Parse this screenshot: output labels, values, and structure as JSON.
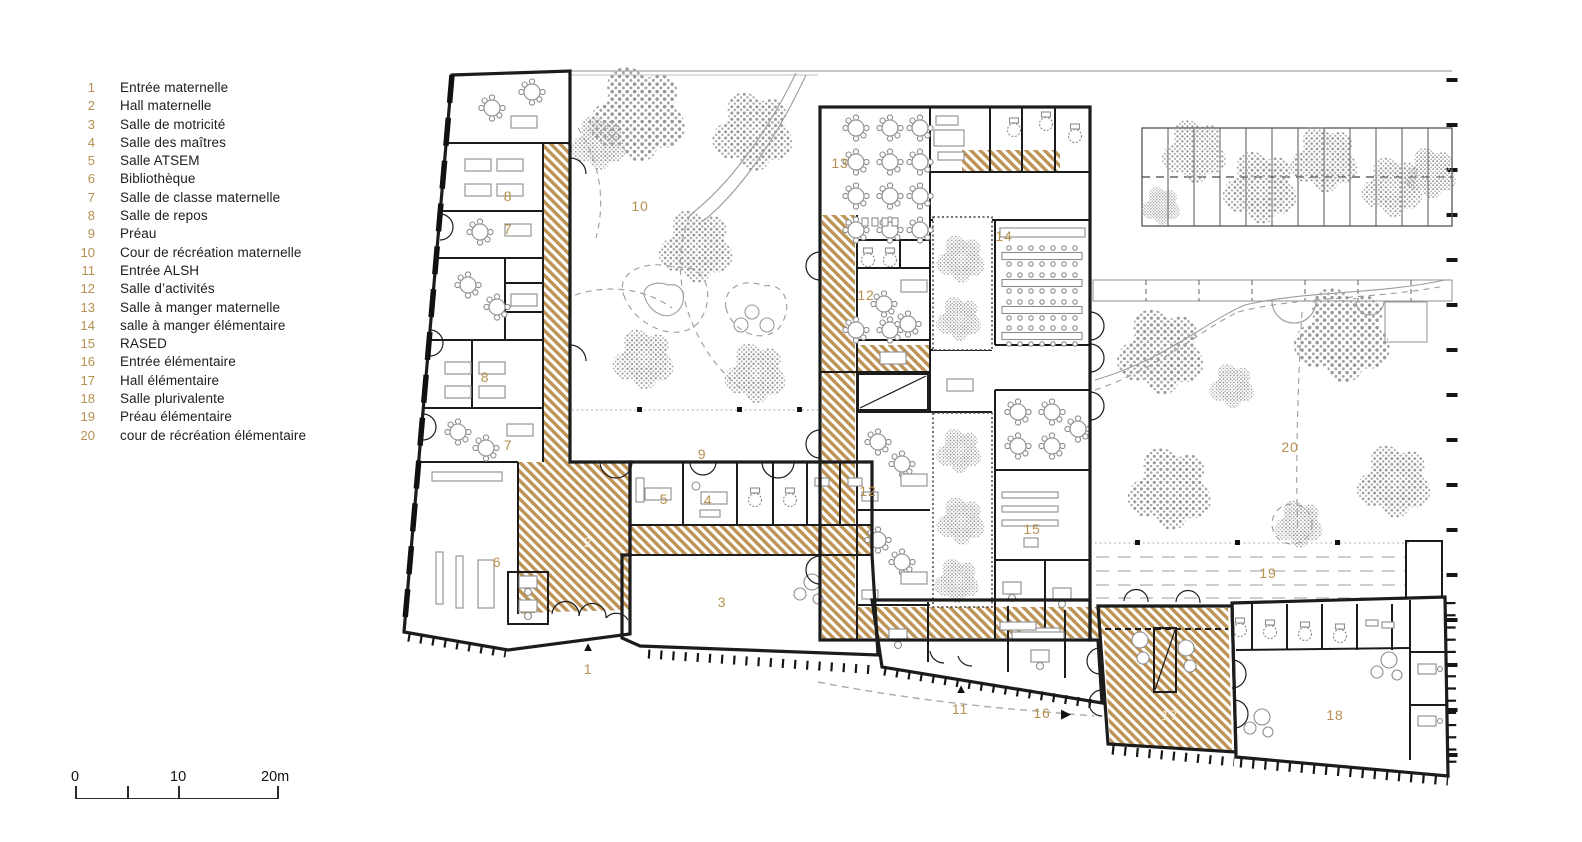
{
  "legend": {
    "items": [
      {
        "num": "1",
        "label": "Entrée maternelle"
      },
      {
        "num": "2",
        "label": "Hall maternelle"
      },
      {
        "num": "3",
        "label": "Salle de motricité"
      },
      {
        "num": "4",
        "label": "Salle des maîtres"
      },
      {
        "num": "5",
        "label": "Salle ATSEM"
      },
      {
        "num": "6",
        "label": "Bibliothèque"
      },
      {
        "num": "7",
        "label": "Salle de classe maternelle"
      },
      {
        "num": "8",
        "label": "Salle de repos"
      },
      {
        "num": "9",
        "label": "Préau"
      },
      {
        "num": "10",
        "label": "Cour de récréation maternelle"
      },
      {
        "num": "11",
        "label": "Entrée ALSH"
      },
      {
        "num": "12",
        "label": "Salle d’activités"
      },
      {
        "num": "13",
        "label": "Salle à manger maternelle"
      },
      {
        "num": "14",
        "label": "salle à manger élémentaire"
      },
      {
        "num": "15",
        "label": "RASED"
      },
      {
        "num": "16",
        "label": "Entrée élémentaire"
      },
      {
        "num": "17",
        "label": "Hall élémentaire"
      },
      {
        "num": "18",
        "label": "Salle plurivalente"
      },
      {
        "num": "19",
        "label": "Préau élémentaire"
      },
      {
        "num": "20",
        "label": "cour de récréation élémentaire"
      }
    ]
  },
  "scale": {
    "ticks": [
      "0",
      "10",
      "20m"
    ]
  },
  "plan": {
    "labels": [
      {
        "num": "8"
      },
      {
        "num": "7"
      },
      {
        "num": "10"
      },
      {
        "num": "13"
      },
      {
        "num": "14"
      },
      {
        "num": "12"
      },
      {
        "num": "8"
      },
      {
        "num": "7"
      },
      {
        "num": "9"
      },
      {
        "num": "12"
      },
      {
        "num": "5"
      },
      {
        "num": "4"
      },
      {
        "num": "15"
      },
      {
        "num": "2"
      },
      {
        "num": "6"
      },
      {
        "num": "3"
      },
      {
        "num": "20"
      },
      {
        "num": "19"
      },
      {
        "num": "1"
      },
      {
        "num": "11"
      },
      {
        "num": "16"
      },
      {
        "num": "17"
      },
      {
        "num": "18"
      }
    ],
    "markers": [
      {
        "name": "entrance-maternelle-marker",
        "glyph": "▲"
      },
      {
        "name": "entrance-alsh-marker",
        "glyph": "▲"
      },
      {
        "name": "entrance-elementaire-marker",
        "glyph": "▶"
      }
    ],
    "colors": {
      "accent_gold": "#b6904f",
      "hatch_gold": "#bd9356",
      "wall_black": "#1c1c1c",
      "tree_gray": "#9a9a9a",
      "line_gray": "#9c9c9c"
    }
  }
}
